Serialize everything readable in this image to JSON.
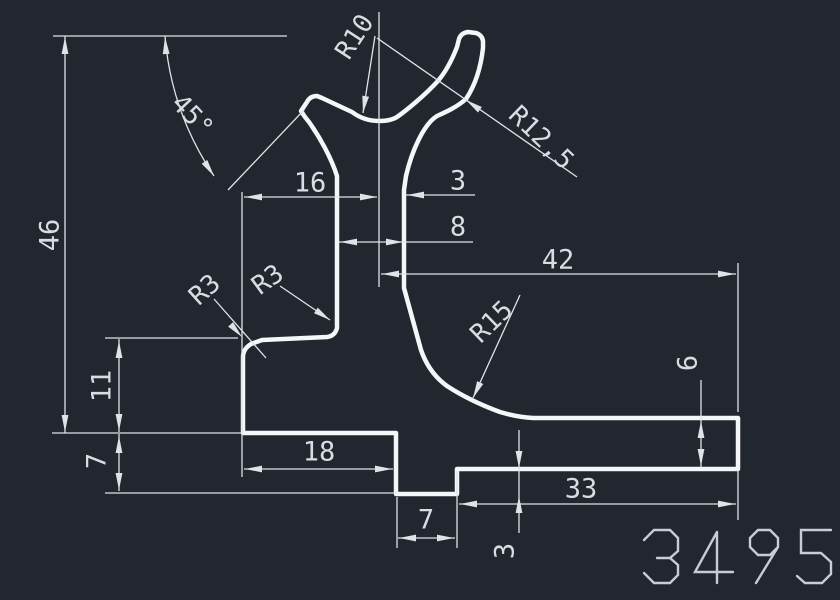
{
  "drawing": {
    "part_number": "3495",
    "labels": {
      "d46": "46",
      "a45": "45°",
      "r10": "R10",
      "r125": "R12,5",
      "w16": "16",
      "w3": "3",
      "w8": "8",
      "w42": "42",
      "r3a": "R3",
      "r3b": "R3",
      "r15": "R15",
      "h11": "11",
      "h7": "7",
      "w18": "18",
      "w7b": "7",
      "w33": "33",
      "h6": "6",
      "h3b": "3"
    },
    "colors": {
      "background": "#22262e",
      "profile_line": "#f4f6f8",
      "dimension_line": "#dfe3e8",
      "dimension_text": "#d9dde3",
      "part_number_text": "#c7cdd5"
    }
  }
}
